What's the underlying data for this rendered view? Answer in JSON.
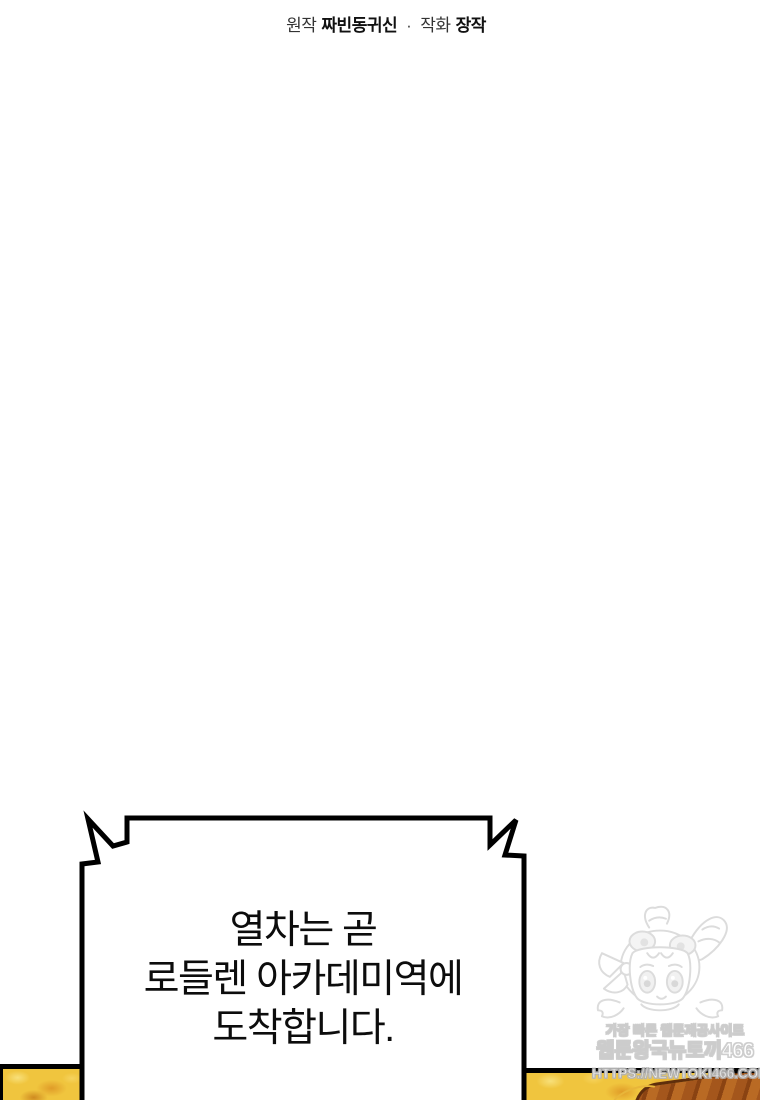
{
  "page": {
    "width": 760,
    "height": 1100,
    "background": "#ffffff"
  },
  "credits": {
    "label_original": "원작",
    "author": "짜빈동귀신",
    "separator": "·",
    "label_art": "작화",
    "artist": "장작"
  },
  "speech_bubble": {
    "shape": "jagged-announcement-box",
    "lines": [
      "열차는 곧",
      "로들렌 아카데미역에",
      "도착합니다."
    ]
  },
  "watermark": {
    "tagline": "가장 빠른 웹툰제공사이트",
    "site_name": "웹툰왕국뉴토끼466",
    "url": "HTTPS://NEWTOKI466.COM",
    "mascot_icon": "chibi-girl-hood-mascot"
  },
  "panels": {
    "left_fragment": "gold-texture-panel",
    "right_fragment": "gold-texture-panel-with-brown-object"
  },
  "colors": {
    "bubble_border": "#000000",
    "bubble_text": "#0c0c0c",
    "panel_gold": "#f0c53e",
    "panel_gold_dark": "#d88f22",
    "panel_brown": "#a4561c",
    "panel_brown_dark": "#5f2e0c",
    "watermark_outline": "#cccccc"
  }
}
